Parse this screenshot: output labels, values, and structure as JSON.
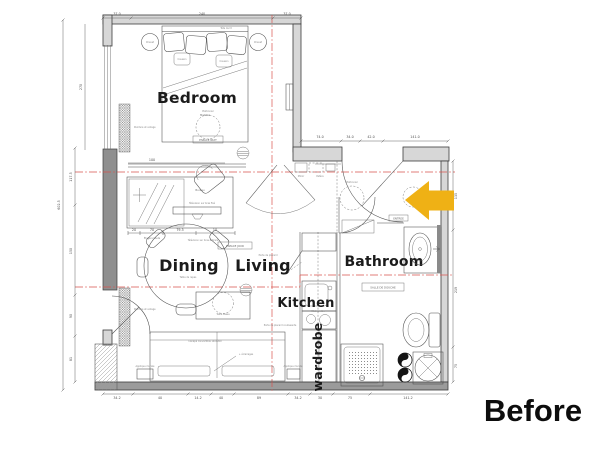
{
  "annotation": {
    "before": "Before"
  },
  "rooms": {
    "bedroom": "Bedroom",
    "dining": "Dining",
    "living": "Living",
    "kitchen": "Kitchen",
    "bathroom": "Bathroom",
    "wardrobe": "wardrobe"
  },
  "zones": {
    "espace_jour": "ESPACE JOUR",
    "espace_nuit": "ESPACE NUIT",
    "entree": "ENTREE",
    "salle_de_douche": "SALLE DE DOUCHE"
  },
  "furniture": {
    "tete_de_lit": "Tête de lit",
    "chevet": "Chevet",
    "coussin": "Coussin",
    "matelas": "Matelas",
    "bureau": "Bureau",
    "tv_fixe": "Télévision sur bras fixé",
    "tv_articule": "Télévision sur bras articulé",
    "etagere_haute": "Étagère haute",
    "table_repas": "Table de repas",
    "table_basse": "Table basse",
    "canape": "Canapé convertible 140x200",
    "eclairages": "+ éclairages",
    "applique": "Applique murale",
    "plafonnier": "Plafonnier",
    "porte_placard": "Porte de placard",
    "porte_placard_coul": "Porte de placard coulissante",
    "kitchenette": "Kitchenette",
    "peinture": "Peinture et voilage",
    "miroir": "Miroir",
    "patere": "Patère"
  },
  "dims": {
    "top": [
      "37.0",
      "240",
      "37.0"
    ],
    "upper_right": [
      "74.0",
      "34.0",
      "42.0",
      "141.0"
    ],
    "left": [
      "270",
      "117.5",
      "150",
      "90",
      "81"
    ],
    "left_overall": "602.5",
    "right": [
      "135",
      "219",
      "75"
    ],
    "bottom": [
      "34.2",
      "40",
      "14.2",
      "40",
      "89",
      "34.2",
      "30",
      "75",
      "141.2"
    ],
    "console": [
      "20",
      "70",
      "79.5",
      "10"
    ],
    "console_top": "100"
  },
  "colors": {
    "arrow": "#EFB115",
    "wall": "#d7d7d7",
    "wall_dark": "#9b9b9b",
    "axis_red": "#d9544f",
    "label_text": "#1b1b1b"
  }
}
